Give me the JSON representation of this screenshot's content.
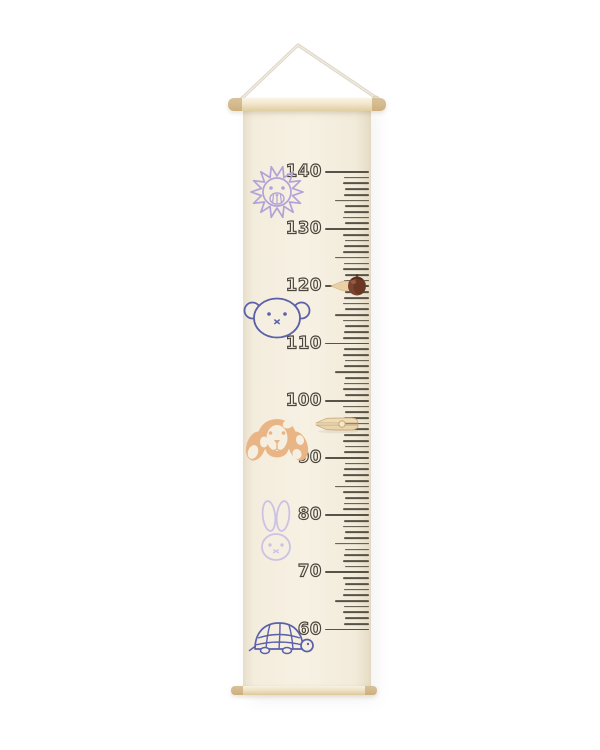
{
  "scene": {
    "type": "product-photo",
    "subject": "children's fabric growth chart hanging from a cord with wooden dowels",
    "background_color": "#ffffff"
  },
  "banner": {
    "fabric_color": "#f5efe1",
    "dowel_color": "#eee1c2",
    "cord_color": "#e4dfd2"
  },
  "ruler": {
    "unit": "cm",
    "major_labels": [
      "140",
      "130",
      "120",
      "110",
      "100",
      "90",
      "80",
      "70",
      "60"
    ],
    "ticks_per_major": 10,
    "ink_color": "#4a443b"
  },
  "animals": [
    {
      "name": "lion",
      "color": "#b2a2d7"
    },
    {
      "name": "bear",
      "color": "#5a61a8"
    },
    {
      "name": "dog",
      "color": "#e9b585",
      "spot_color": "#f5efe1"
    },
    {
      "name": "rabbit",
      "color": "#ccc2e3"
    },
    {
      "name": "turtle",
      "color": "#5a61a8"
    }
  ],
  "markers": [
    {
      "name": "wooden-bead-marker",
      "at_label": "120",
      "bead_color": "#7c4330",
      "pointer_color": "#ead0a6"
    },
    {
      "name": "wooden-clothespin",
      "at_label": "96",
      "color": "#eedcb8"
    }
  ]
}
